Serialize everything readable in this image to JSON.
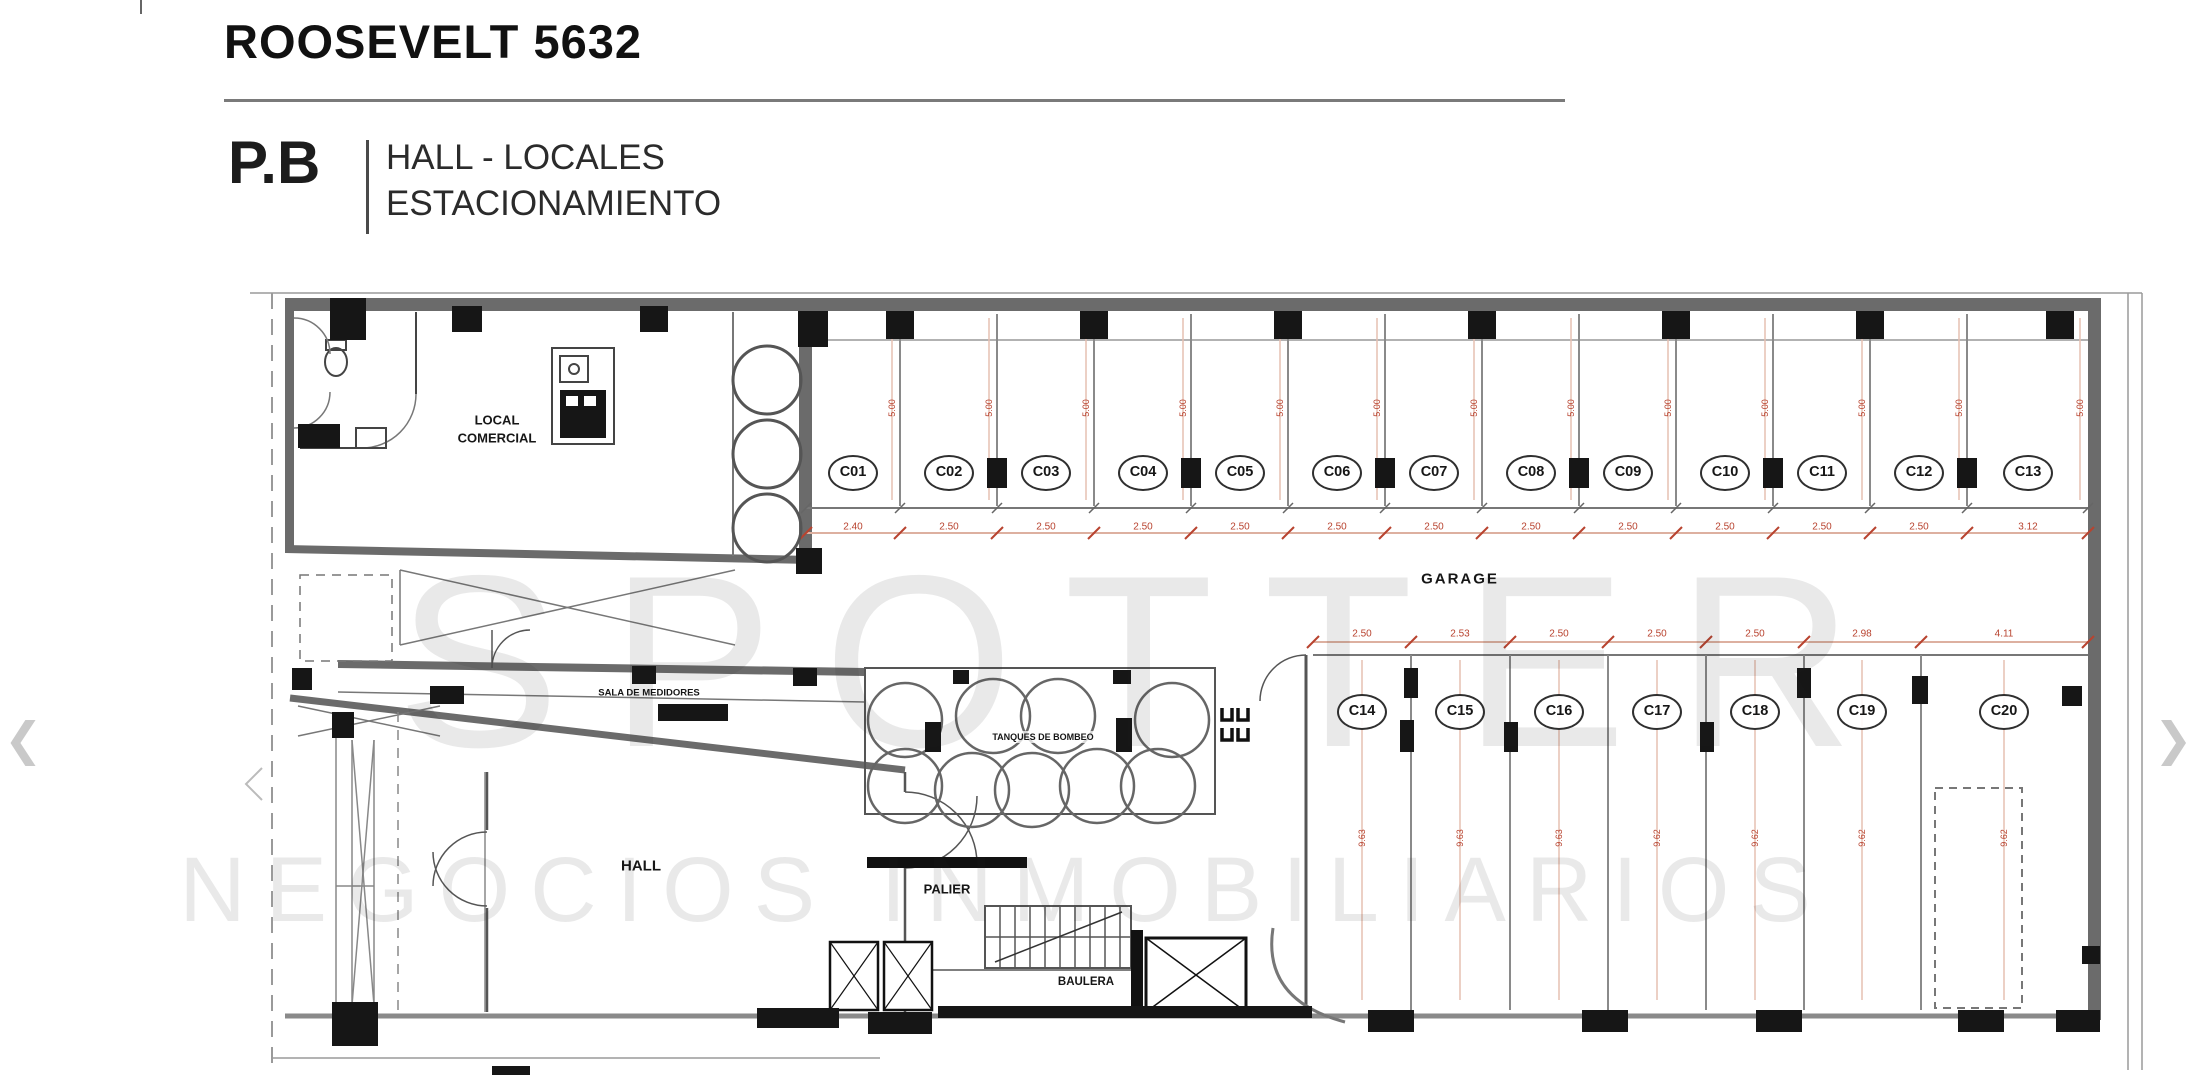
{
  "header": {
    "title": "ROOSEVELT 5632",
    "floor": "P.B",
    "subtitle_line1": "HALL - LOCALES",
    "subtitle_line2": "ESTACIONAMIENTO"
  },
  "watermark": {
    "brand": "SPOTTER",
    "tagline": "NEGOCIOS INMOBILIARIOS"
  },
  "rooms": {
    "local_comercial_line1": "LOCAL",
    "local_comercial_line2": "COMERCIAL",
    "garage": "GARAGE",
    "sala_de_medidores": "SALA DE MEDIDORES",
    "tanques_de_bombeo": "TANQUES DE BOMBEO",
    "hall": "HALL",
    "palier": "PALIER",
    "baulera": "BAULERA"
  },
  "parking_top": {
    "depth_note": "5.00",
    "spots": [
      {
        "label": "C01",
        "width": "2.40"
      },
      {
        "label": "C02",
        "width": "2.50"
      },
      {
        "label": "C03",
        "width": "2.50"
      },
      {
        "label": "C04",
        "width": "2.50"
      },
      {
        "label": "C05",
        "width": "2.50"
      },
      {
        "label": "C06",
        "width": "2.50"
      },
      {
        "label": "C07",
        "width": "2.50"
      },
      {
        "label": "C08",
        "width": "2.50"
      },
      {
        "label": "C09",
        "width": "2.50"
      },
      {
        "label": "C10",
        "width": "2.50"
      },
      {
        "label": "C11",
        "width": "2.50"
      },
      {
        "label": "C12",
        "width": "2.50"
      },
      {
        "label": "C13",
        "width": "3.12"
      }
    ]
  },
  "parking_bottom": {
    "spots": [
      {
        "label": "C14",
        "width": "2.50",
        "depth": "9.63"
      },
      {
        "label": "C15",
        "width": "2.53",
        "depth": "9.63"
      },
      {
        "label": "C16",
        "width": "2.50",
        "depth": "9.63"
      },
      {
        "label": "C17",
        "width": "2.50",
        "depth": "9.62"
      },
      {
        "label": "C18",
        "width": "2.50",
        "depth": "9.62"
      },
      {
        "label": "C19",
        "width": "2.98",
        "depth": "9.62"
      },
      {
        "label": "C20",
        "width": "4.11",
        "depth": "9.62"
      }
    ]
  },
  "nav": {
    "prev": "❮",
    "next": "❯"
  },
  "colors": {
    "dimension_text": "#b8432f",
    "dimension_line": "#ddb0a0",
    "wall_gray": "#6b6b6b",
    "line_black": "#161616",
    "watermark_gray": "#e9e9e9"
  }
}
